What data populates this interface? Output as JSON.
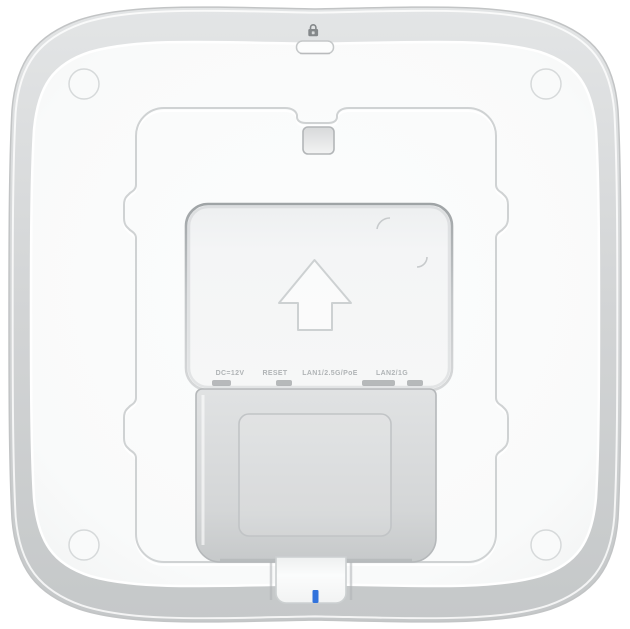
{
  "device": {
    "title": "wireless access point - rear view",
    "port_labels": {
      "power": "DC=12V",
      "reset": "RESET",
      "lan1": "LAN1/2.5G/PoE",
      "lan2": "LAN2/1G"
    },
    "icons": {
      "lock": "security-lock-icon",
      "arrow": "mounting-direction-arrow",
      "led": "status-led"
    },
    "colors": {
      "led_blue": "#3273dc",
      "face_white": "#fafbfb",
      "rim_gray": "#cdd0d1",
      "label_text": "#b0b4b6"
    }
  }
}
